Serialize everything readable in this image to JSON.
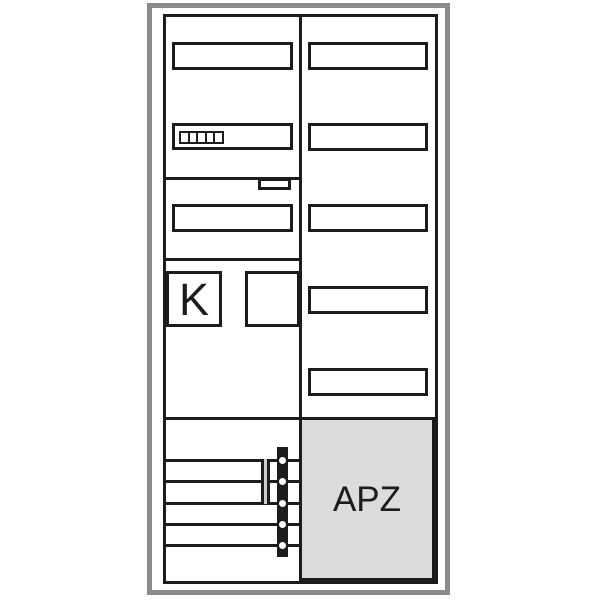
{
  "cabinet": {
    "k_field": {
      "label": "K"
    },
    "apz_field": {
      "label": "APZ"
    },
    "colors": {
      "line": "#1c1c1c",
      "frame": "#8a8a8a",
      "apz_fill": "#dcdcdc",
      "holder_fill": "#cccccc",
      "background": "#ffffff"
    },
    "structure": {
      "left_slots": 3,
      "right_slots": 5,
      "module_cells": 5,
      "busbar_rows": 5,
      "terminal_points": 5
    }
  }
}
